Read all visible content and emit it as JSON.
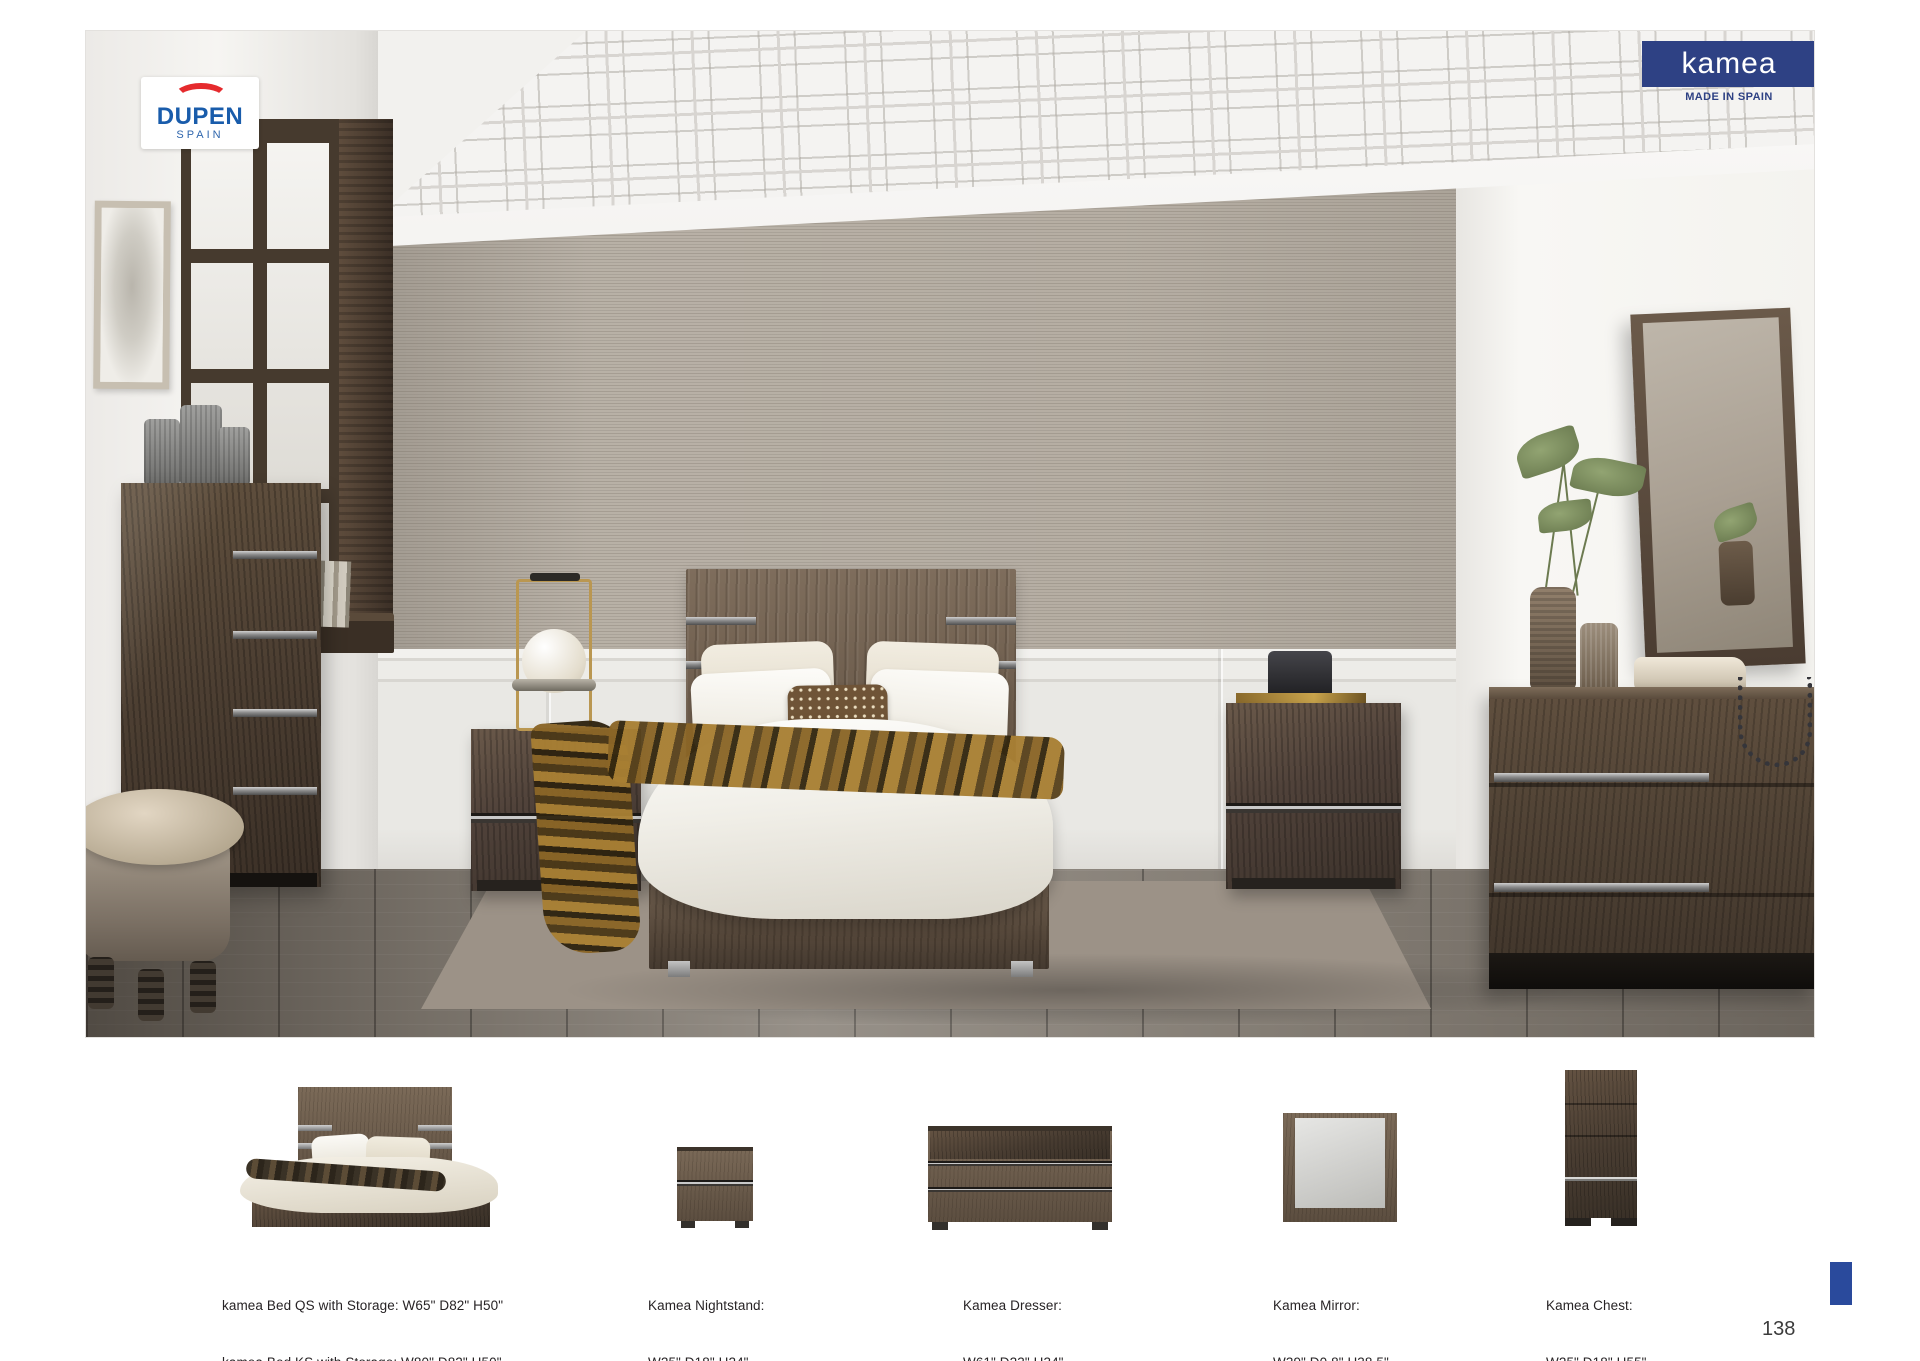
{
  "banner": {
    "collection": "kamea",
    "origin": "MADE IN SPAIN"
  },
  "brand": {
    "name": "DUPEN",
    "country": "SPAIN"
  },
  "page": {
    "number": "138"
  },
  "colors": {
    "banner_navy": "#2e4184",
    "corner_square_blue": "#2a4a9c",
    "dupen_blue": "#195cab",
    "dupen_red": "#e52a2d",
    "caption_text": "#272325"
  },
  "products": [
    {
      "name": "bed",
      "caption_line1": "kamea Bed QS with Storage: W65\" D82\" H50\"",
      "caption_line2": "kamea Bed KS with Storage: W80\" D82\" H50\""
    },
    {
      "name": "nightstand",
      "caption_line1": "Kamea Nightstand:",
      "caption_line2": "W25\" D18\" H24\""
    },
    {
      "name": "dresser",
      "caption_line1": "Kamea Dresser:",
      "caption_line2": "W61\" D23\" H34\""
    },
    {
      "name": "mirror",
      "caption_line1": "Kamea Mirror:",
      "caption_line2": "W39\" D0.8\" H38.5\""
    },
    {
      "name": "chest",
      "caption_line1": "Kamea Chest:",
      "caption_line2": "W25\" D18\" H55\""
    }
  ]
}
